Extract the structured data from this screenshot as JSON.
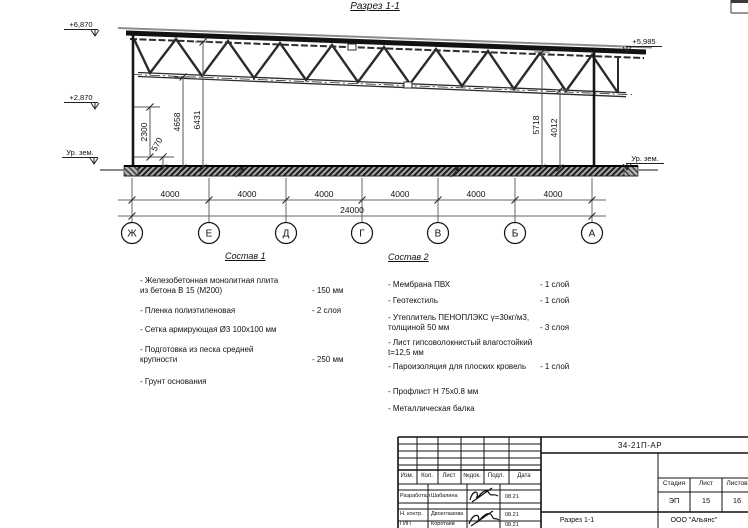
{
  "page": {
    "section_title": "Разрез 1-1"
  },
  "drawing": {
    "elev_left_top": "+6,870",
    "elev_left_mid": "+2,870",
    "elev_left_ground": "Ур. зем.",
    "elev_right_top": "+5,985",
    "elev_right_ground": "Ур. зем.",
    "dim_2300": "2300",
    "dim_570": "570",
    "dim_4658": "4658",
    "dim_6431": "6431",
    "dim_5718": "5718",
    "dim_4012": "4012",
    "bay_dims": [
      "4000",
      "4000",
      "4000",
      "4000",
      "4000",
      "4000"
    ],
    "total_dim": "24000",
    "axes": [
      "Ж",
      "Е",
      "Д",
      "Г",
      "В",
      "Б",
      "А"
    ]
  },
  "sostav1": {
    "title": "Состав 1",
    "items": [
      {
        "text": "- Железобетонная  монолитная плита\nиз бетона В 15 (М200)",
        "value": "- 150 мм"
      },
      {
        "text": "- Пленка полиэтиленовая",
        "value": "- 2 слоя"
      },
      {
        "text": "- Сетка армирующая Ø3 100х100 мм",
        "value": ""
      },
      {
        "text": "- Подготовка из песка средней\nкрупности",
        "value": "- 250 мм"
      },
      {
        "text": "- Грунт основания",
        "value": ""
      }
    ]
  },
  "sostav2": {
    "title": "Состав 2",
    "items": [
      {
        "text": "- Мембрана ПВХ",
        "value": "- 1 слой"
      },
      {
        "text": "- Геотекстиль",
        "value": "- 1 слой"
      },
      {
        "text": "- Утеплитель ПЕНОПЛЭКС γ=30кг/м3,\nтолщиной 50 мм",
        "value": "- 3 слоя"
      },
      {
        "text": "- Лист гипсоволокнистый влагостойкий\nt=12,5 мм",
        "value": ""
      },
      {
        "text": "- Пароизоляция для плоских кровель",
        "value": "- 1 слой"
      },
      {
        "text": "- Профлист Н 75х0.8 мм",
        "value": ""
      },
      {
        "text": "- Металлическая балка",
        "value": ""
      }
    ]
  },
  "titleblock": {
    "doc_number": "34-21П-АР",
    "columns": [
      "Изм.",
      "Кол.",
      "Лист",
      "№док.",
      "Подл.",
      "Дата"
    ],
    "sign_rows": [
      {
        "role": "Разработал",
        "name": "Шабалина",
        "date": "08.21"
      },
      {
        "role": "Н. контр.",
        "name": "Двоеглазова",
        "date": "08.21"
      },
      {
        "role": "ГИП",
        "name": "Коротаев",
        "date": "08.21"
      }
    ],
    "stage_cols": [
      "Стадия",
      "Лист",
      "Листов"
    ],
    "stage_vals": [
      "ЭП",
      "15",
      "16"
    ],
    "sheet_title": "Разрез 1-1",
    "company": "ООО \"Альянс\""
  }
}
